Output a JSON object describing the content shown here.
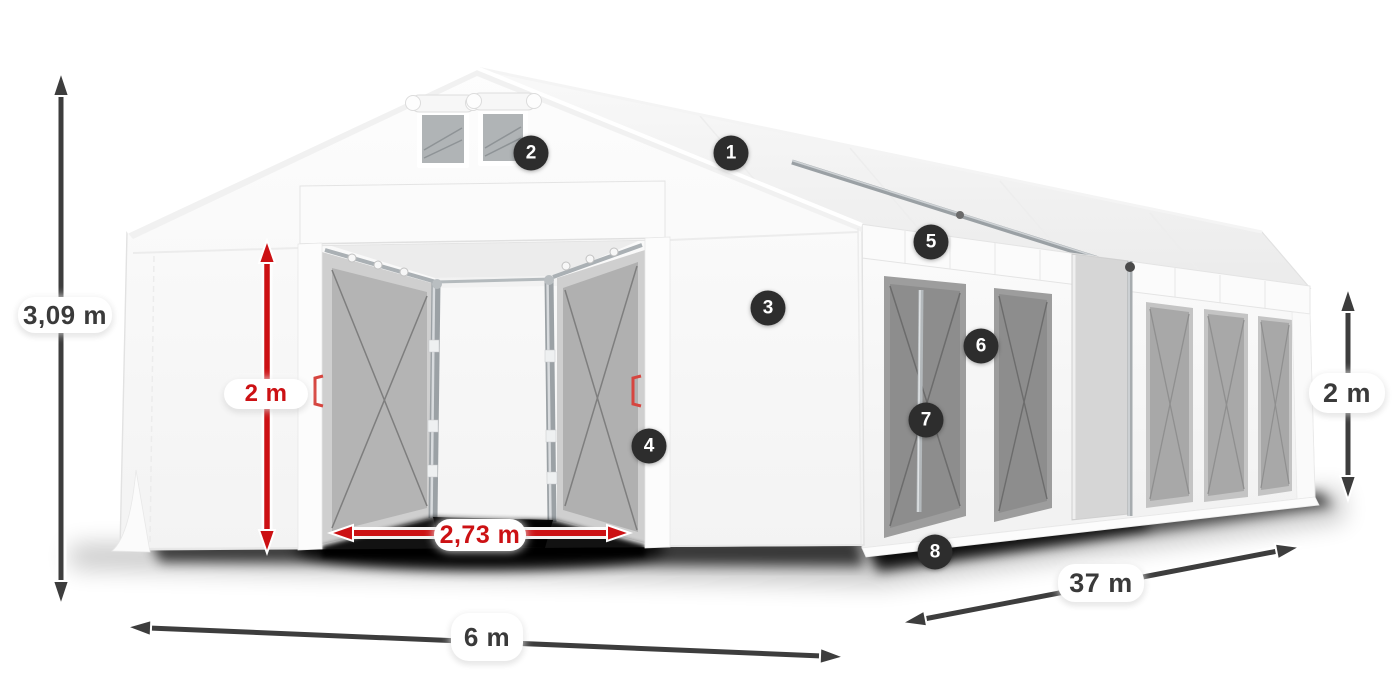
{
  "diagram": {
    "subject": "marquee-tent-dimension-diagram",
    "background_color": "#ffffff",
    "colors": {
      "accent_red": "#cc1114",
      "arrow_dark": "#3d3d3d",
      "badge_background": "#2d2d2d",
      "pill_background": "#ffffff",
      "tent_white": "#fbfbfb"
    }
  },
  "dimensions": {
    "total_height": {
      "label": "3,09 m",
      "color": "dark"
    },
    "entrance_height": {
      "label": "2 m",
      "color": "red"
    },
    "entrance_width": {
      "label": "2,73 m",
      "color": "red"
    },
    "width": {
      "label": "6 m",
      "color": "dark"
    },
    "length": {
      "label": "37 m",
      "color": "dark"
    },
    "side_height": {
      "label": "2 m",
      "color": "dark"
    }
  },
  "badges": [
    {
      "number": "1"
    },
    {
      "number": "2"
    },
    {
      "number": "3"
    },
    {
      "number": "4"
    },
    {
      "number": "5"
    },
    {
      "number": "6"
    },
    {
      "number": "7"
    },
    {
      "number": "8"
    }
  ]
}
